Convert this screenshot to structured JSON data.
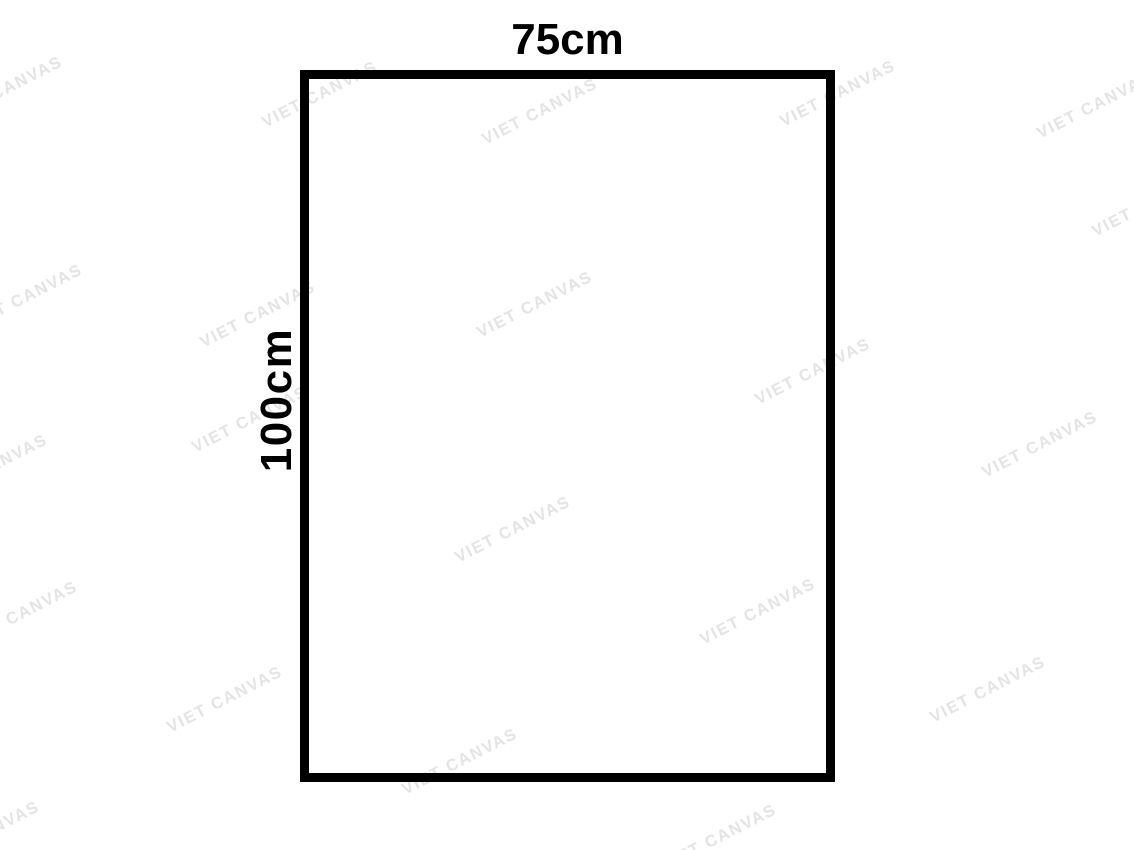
{
  "canvas": {
    "width_label": "75cm",
    "height_label": "100cm",
    "border_color": "#000000",
    "label_color": "#000000",
    "background_color": "#ffffff"
  },
  "watermark": {
    "text": "VIET CANVAS",
    "color": "#e4e4e4",
    "angle_deg": -27,
    "positions": [
      {
        "x": 5,
        "y": 90
      },
      {
        "x": 320,
        "y": 95
      },
      {
        "x": 540,
        "y": 112
      },
      {
        "x": 838,
        "y": 94
      },
      {
        "x": 1095,
        "y": 106
      },
      {
        "x": 1150,
        "y": 204
      },
      {
        "x": 25,
        "y": 298
      },
      {
        "x": 258,
        "y": 315
      },
      {
        "x": 535,
        "y": 305
      },
      {
        "x": 813,
        "y": 372
      },
      {
        "x": -10,
        "y": 468
      },
      {
        "x": 250,
        "y": 420
      },
      {
        "x": 1040,
        "y": 445
      },
      {
        "x": 513,
        "y": 530
      },
      {
        "x": 758,
        "y": 612
      },
      {
        "x": 20,
        "y": 615
      },
      {
        "x": 225,
        "y": 700
      },
      {
        "x": 988,
        "y": 690
      },
      {
        "x": 460,
        "y": 762
      },
      {
        "x": -18,
        "y": 835
      },
      {
        "x": 719,
        "y": 838
      }
    ]
  }
}
